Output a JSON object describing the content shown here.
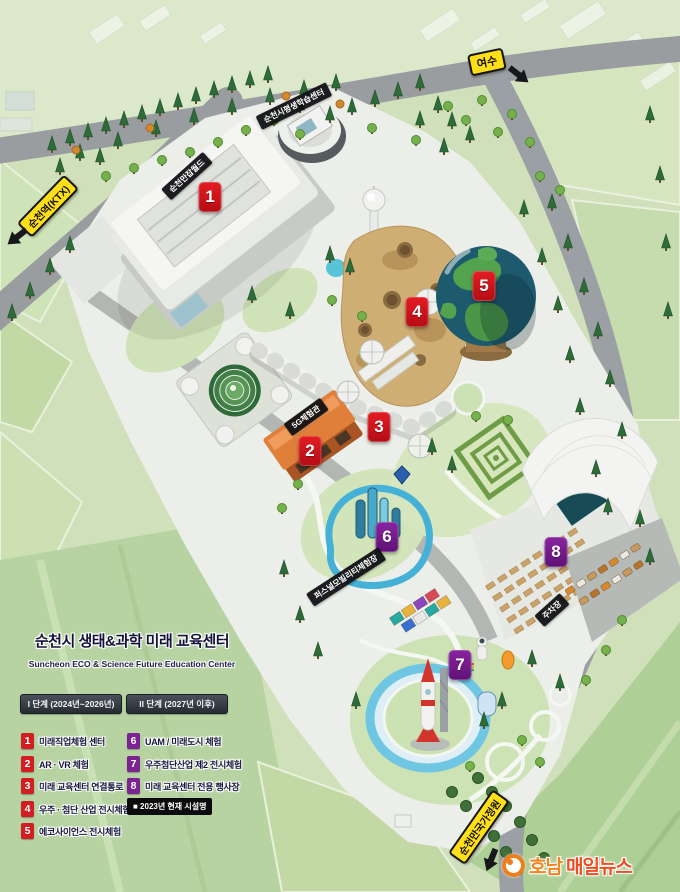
{
  "legend": {
    "title": "순천시 생태&과학 미래 교육센터",
    "subtitle": "Suncheon ECO & Science Future Education Center",
    "phase1": {
      "header": "I 단계 (2024년~2026년)",
      "items": [
        {
          "num": "1",
          "label": "미래직업체험 센터"
        },
        {
          "num": "2",
          "label": "AR · VR 체험"
        },
        {
          "num": "3",
          "label": "미래 교육센터 연결통로"
        },
        {
          "num": "4",
          "label": "우주 · 첨단 산업 전시체험"
        },
        {
          "num": "5",
          "label": "에코사이언스 전시체험"
        }
      ]
    },
    "phase2": {
      "header": "II 단계 (2027년 이후)",
      "items": [
        {
          "num": "6",
          "label": "UAM / 미래도시 체험"
        },
        {
          "num": "7",
          "label": "우주첨단산업 제2 전시체험"
        },
        {
          "num": "8",
          "label": "미래 교육센터 전용 행사장"
        }
      ]
    },
    "note": "■ 2023년 현재 시설명"
  },
  "markers": [
    {
      "num": "1",
      "color": "#d8161f"
    },
    {
      "num": "2",
      "color": "#d8161f"
    },
    {
      "num": "3",
      "color": "#d8161f"
    },
    {
      "num": "4",
      "color": "#d8161f"
    },
    {
      "num": "5",
      "color": "#d8161f"
    },
    {
      "num": "6",
      "color": "#7a2391"
    },
    {
      "num": "7",
      "color": "#7a2391"
    },
    {
      "num": "8",
      "color": "#7a2391"
    }
  ],
  "map_labels": [
    {
      "text": "순천만잡월드"
    },
    {
      "text": "순천시평생학습센터"
    },
    {
      "text": "5G체험관"
    },
    {
      "text": "퍼스널모빌리티체험장"
    },
    {
      "text": "주차장"
    }
  ],
  "direction_signs": [
    {
      "label": "여수"
    },
    {
      "label": "순천역(KTX)"
    },
    {
      "label": "순천만국가정원"
    }
  ],
  "logo": {
    "prefix": "호남",
    "suffix": "매일뉴스"
  },
  "colors": {
    "phase1_marker": "#d8161f",
    "phase2_marker": "#7a2391",
    "sign_yellow": "#ffdf17",
    "label_black": "#0c0d10",
    "logo_orange": "#f5831f",
    "logo_red": "#ee4e23"
  }
}
